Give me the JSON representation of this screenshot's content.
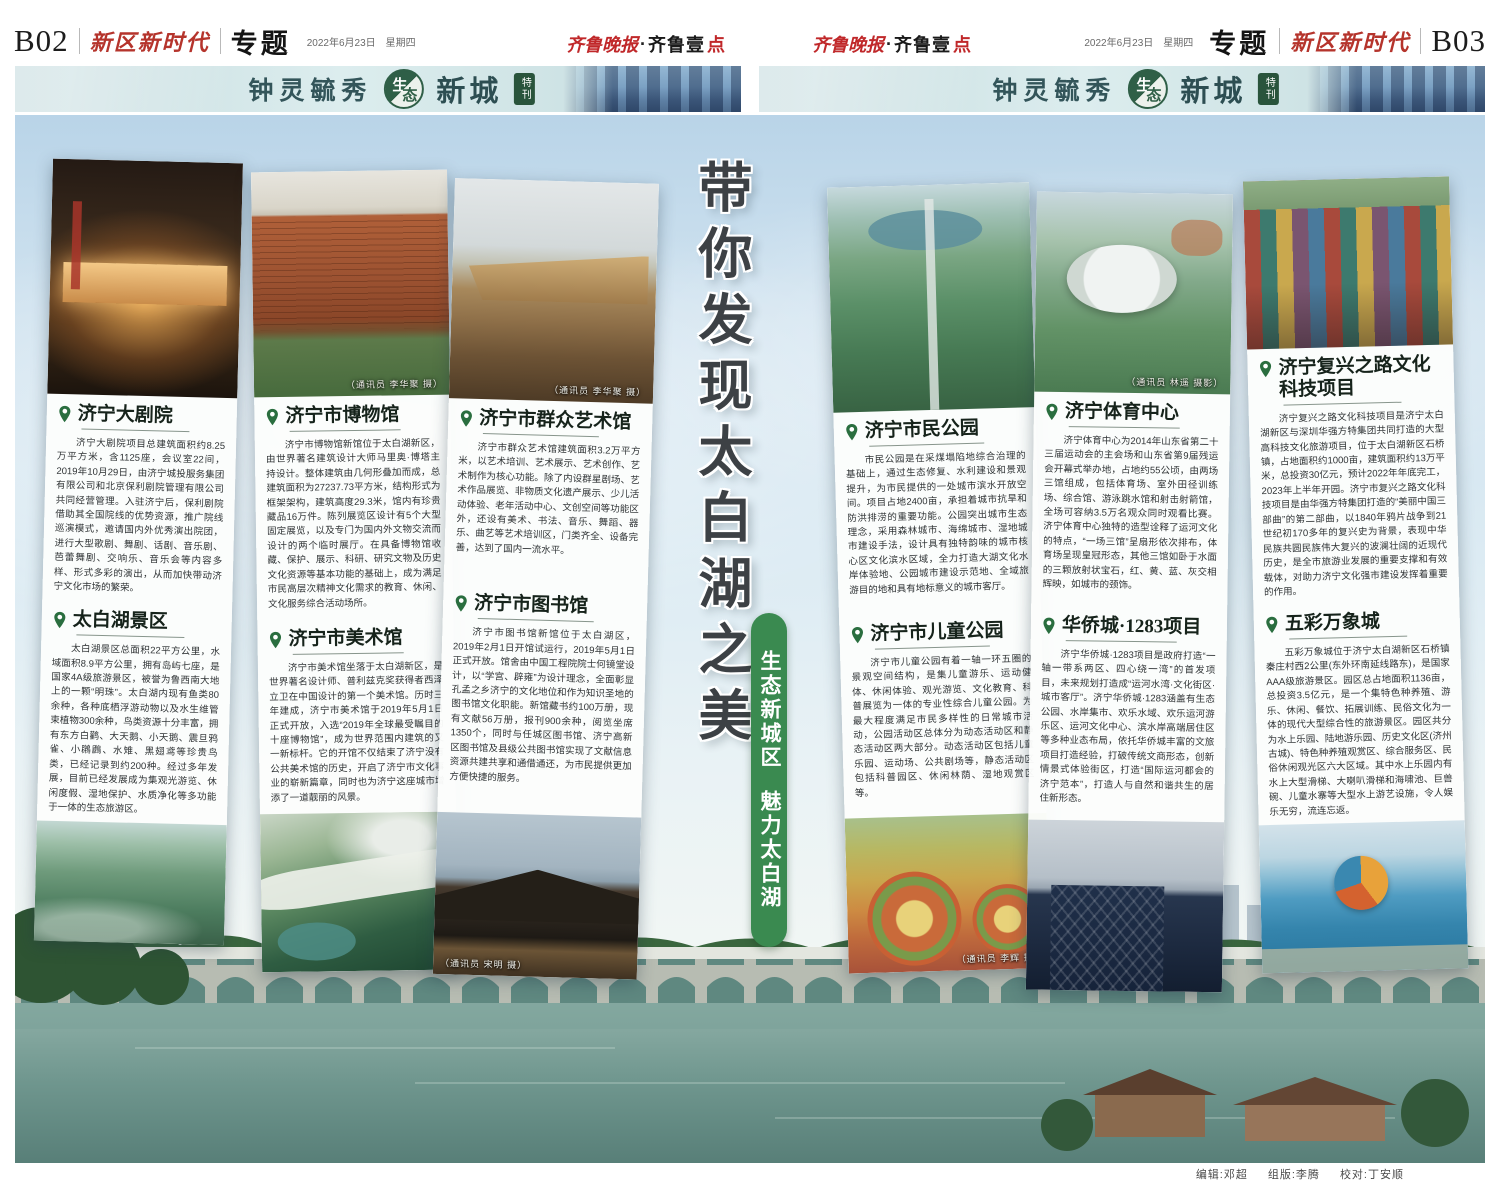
{
  "page_left": {
    "page_number": "B02",
    "masthead": "新区新时代",
    "section": "专题",
    "date": "2022年6月23日",
    "weekday": "星期四"
  },
  "page_right": {
    "page_number": "B03",
    "masthead": "新区新时代",
    "section": "专题",
    "date": "2022年6月23日",
    "weekday": "星期四"
  },
  "logo": {
    "part_red": "齐鲁晚报",
    "separator": "·",
    "part_black": "齐鲁壹",
    "part_accent": "点"
  },
  "banner": {
    "slogan_prefix": "钟灵毓秀",
    "eco_char_1": "生",
    "eco_char_2": "态",
    "slogan_suffix": "新城",
    "special_badge": "特刊"
  },
  "center": {
    "headline": "带你发现太白湖之美",
    "badge_line_1": "生态新城区",
    "badge_line_2": "魅力太白湖"
  },
  "articles": [
    {
      "title": "济宁大剧院",
      "body": "济宁大剧院项目总建筑面积约8.25万平方米，含1125座，会议室22间，2019年10月29日，由济宁城投服务集团有限公司和北京保利剧院管理有限公司共同经营管理。入驻济宁后，保利剧院借助其全国院线的优势资源，推广院线巡演模式，邀请国内外优秀演出院团，进行大型歌剧、舞剧、话剧、音乐剧、芭蕾舞剧、交响乐、音乐会等内容多样、形式多彩的演出，从而加快带动济宁文化市场的繁荣。"
    },
    {
      "title": "太白湖景区",
      "body": "太白湖景区总面积22平方公里，水域面积8.9平方公里，拥有岛屿七座，是国家4A级旅游景区，被誉为鲁西南大地上的一颗“明珠”。太白湖内现有鱼类80余种，各种底栖浮游动物以及水生维管束植物300余种，鸟类资源十分丰富，拥有东方白鹳、大天鹅、小天鹅、震旦鸦雀、小鸊鷉、水雉、黑翅鸢等珍贵鸟类，已经记录到约200种。经过多年发展，目前已经发展成为集观光游览、休闲度假、湿地保护、水质净化等多功能于一体的生态旅游区。"
    },
    {
      "title": "济宁市博物馆",
      "body": "济宁市博物馆新馆位于太白湖新区，由世界著名建筑设计大师马里奥·博塔主持设计。整体建筑由几何形叠加而成，总建筑面积为27237.73平方米，结构形式为框架架构，建筑高度29.3米，馆内有珍贵藏品16万件。陈列展览区设计有5个大型固定展览，以及专门为国内外文物交流而设计的两个临时展厅。在具备博物馆收藏、保护、展示、科研、研究文物及历史文化资源等基本功能的基础上，成为满足市民高层次精神文化需求的教育、休闲、文化服务综合活动场所。"
    },
    {
      "title": "济宁市美术馆",
      "body": "济宁市美术馆坐落于太白湖新区，是世界著名设计师、普利兹克奖获得者西泽立卫在中国设计的第一个美术馆。历时三年建成，济宁市美术馆于2019年5月1日正式开放，入选“2019年全球最受瞩目的十座博物馆”，成为世界范围内建筑的又一新标杆。它的开馆不仅结束了济宁没有公共美术馆的历史，开启了济宁市文化事业的崭新篇章，同时也为济宁这座城市增添了一道靓丽的风景。"
    },
    {
      "title": "济宁市群众艺术馆",
      "body": "济宁市群众艺术馆建筑面积3.2万平方米，以艺术培训、艺术展示、艺术创作、艺术制作为核心功能。除了内设群星剧场、艺术作品展览、非物质文化遗产展示、少儿活动体验、老年活动中心、文创空间等功能区外，还设有美术、书法、音乐、舞蹈、器乐、曲艺等艺术培训区，门类齐全、设备完善，达到了国内一流水平。"
    },
    {
      "title": "济宁市图书馆",
      "body": "济宁市图书馆新馆位于太白湖区，2019年2月1日开馆试运行，2019年5月1日正式开放。馆舍由中国工程院院士何镜堂设计，以“学宫、辟雍”为设计理念，全面彰显孔孟之乡济宁的文化地位和作为知识圣地的图书馆文化职能。新馆藏书约100万册，现有文献56万册，报刊900余种，阅览坐席1350个，同时与任城区图书馆、济宁高新区图书馆及县级公共图书馆实现了文献信息资源共建共享和通借通还，为市民提供更加方便快捷的服务。"
    },
    {
      "title": "济宁市民公园",
      "body": "市民公园是在采煤塌陷地综合治理的基础上，通过生态修复、水利建设和景观提升，为市民提供的一处城市滨水开放空间。项目占地2400亩，承担着城市抗旱和防洪排涝的重要功能。公园突出城市生态理念，采用森林城市、海绵城市、湿地城市建设手法，设计具有独特韵味的城市核心区文化滨水区域，全力打造大湖文化水岸体验地、公园城市建设示范地、全域旅游目的地和具有地标意义的城市客厅。"
    },
    {
      "title": "济宁市儿童公园",
      "body": "济宁市儿童公园有着一轴一环五圈的景观空间结构，是集儿童游乐、运动健体、休闲体验、观光游览、文化教育、科普展览为一体的专业性综合儿童公园。为最大程度满足市民多样性的日常城市活动，公园活动区总体分为动态活动区和静态活动区两大部分。动态活动区包括儿童乐园、运动场、公共剧场等，静态活动区包括科普园区、休闲林荫、湿地观赏区等。"
    },
    {
      "title": "济宁体育中心",
      "body": "济宁体育中心为2014年山东省第二十三届运动会的主会场和山东省第9届残运会开幕式举办地，占地约55公顷，由两场三馆组成，包括体育场、室外田径训练场、综合馆、游泳跳水馆和射击射箭馆，全场可容纳3.5万名观众同时观看比赛。济宁体育中心独特的造型诠释了运河文化的特点，“一场三馆”呈扇形依次排布，体育场呈现皇冠形态，其他三馆如卧于水面的三颗放射状宝石，红、黄、蓝、灰交相辉映，如城市的颈饰。"
    },
    {
      "title": "华侨城·1283项目",
      "body": "济宁华侨城·1283项目是政府打造“一轴一带系两区、四心绕一湾”的首发项目，未来规划打造成“运河水湾·文化街区·城市客厅”。济宁华侨城·1283涵盖有生态公园、水岸集市、欢乐水域、欢乐运河游乐区、运河文化中心、滨水岸高端居住区等多种业态布局，依托华侨城丰富的文旅项目打造经验，打破传统文商形态，创新情景式体验街区，打造“国际运河都会的济宁范本”，打造人与自然和谐共生的居住新形态。"
    },
    {
      "title": "济宁复兴之路文化科技项目",
      "body": "济宁复兴之路文化科技项目是济宁太白湖新区与深圳华强方特集团共同打造的大型高科技文化旅游项目，位于太白湖新区石桥镇，占地面积约1000亩，建筑面积约13万平米，总投资30亿元，预计2022年年底完工，2023年上半年开园。济宁市复兴之路文化科技项目是由华强方特集团打造的“美丽中国三部曲”的第二部曲，以1840年鸦片战争到21世纪初170多年的复兴史为背景，表现中华民族共圆民族伟大复兴的波澜壮阔的近现代历史，是全市旅游业发展的重要支撑和有效载体，对助力济宁文化强市建设发挥着重要的作用。"
    },
    {
      "title": "五彩万象城",
      "body": "五彩万象城位于济宁太白湖新区石桥镇秦庄村西2公里(东外环南延线路东)，是国家AAA级旅游景区。园区总占地面积1136亩，总投资3.5亿元，是一个集特色种养殖、游乐、休闲、餐饮、拓展训练、民俗文化为一体的现代大型综合性的旅游景区。园区共分为水上乐园、陆地游乐园、历史文化区(济州古城)、特色种养殖观赏区、综合服务区、民俗休闲观光区六大区域。其中水上乐园内有水上大型滑梯、大喇叭滑梯和海啸池、巨兽碗、儿童水寨等大型水上游艺设施，令人娱乐无穷，流连忘返。"
    }
  ],
  "captions": {
    "museum": "（通讯员 李华聚 摄）",
    "mass_art": "（通讯员 李华聚 摄）",
    "library": "（通讯员 宋明 摄）",
    "children": "（通讯员 李辉 摄）",
    "sports": "（通讯员 林遥 摄影）"
  },
  "credits": {
    "editor": "编辑:邓超",
    "layout": "组版:李腾",
    "proofread": "校对:丁安顺"
  },
  "colors": {
    "accent_green": "#3a8a50",
    "masthead_red": "#b5342c",
    "pin_green": "#2a6e3f",
    "banner_teal": "#cfe3e5"
  }
}
